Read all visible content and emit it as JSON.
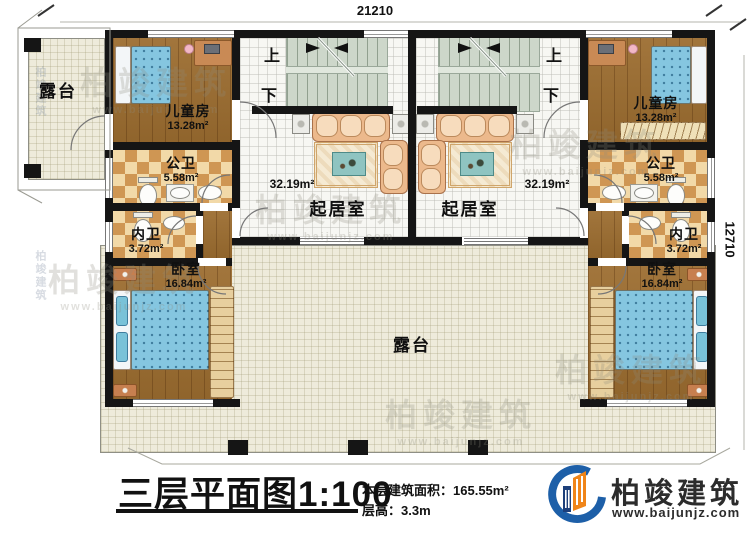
{
  "plan": {
    "dim_top": "21210",
    "dim_right": "12710",
    "stair_up": "上",
    "stair_down": "下",
    "rooms": {
      "terrace_small": {
        "label": "露台"
      },
      "terrace_main": {
        "label": "露台"
      },
      "children_left": {
        "label": "儿童房",
        "area": "13.28m²"
      },
      "children_right": {
        "label": "儿童房",
        "area": "13.28m²"
      },
      "public_bath_left": {
        "label": "公卫",
        "area": "5.58m²"
      },
      "public_bath_right": {
        "label": "公卫",
        "area": "5.58m²"
      },
      "inner_bath_left": {
        "label": "内卫",
        "area": "3.72m²"
      },
      "inner_bath_right": {
        "label": "内卫",
        "area": "3.72m²"
      },
      "bedroom_left": {
        "label": "卧室",
        "area": "16.84m²"
      },
      "bedroom_right": {
        "label": "卧室",
        "area": "16.84m²"
      },
      "living_left": {
        "label": "起居室",
        "area": "32.19m²"
      },
      "living_right": {
        "label": "起居室",
        "area": "32.19m²"
      }
    }
  },
  "title_block": {
    "title": "三层平面图",
    "scale": "1:100",
    "area_label": "本层建筑面积：",
    "area_value": "165.55m²",
    "height_label": "层高：",
    "height_value": "3.3m"
  },
  "brand": {
    "name": "柏竣建筑",
    "website": "www.baijunjz.com"
  },
  "colors": {
    "wall": "#151515",
    "tile_dark": "#cf9653",
    "tile_light": "#f2d9a8",
    "wood": "#9c6d30",
    "terrace": "#eeebdb",
    "logo_blue": "#1d5fa8",
    "logo_orange": "#f08519"
  }
}
